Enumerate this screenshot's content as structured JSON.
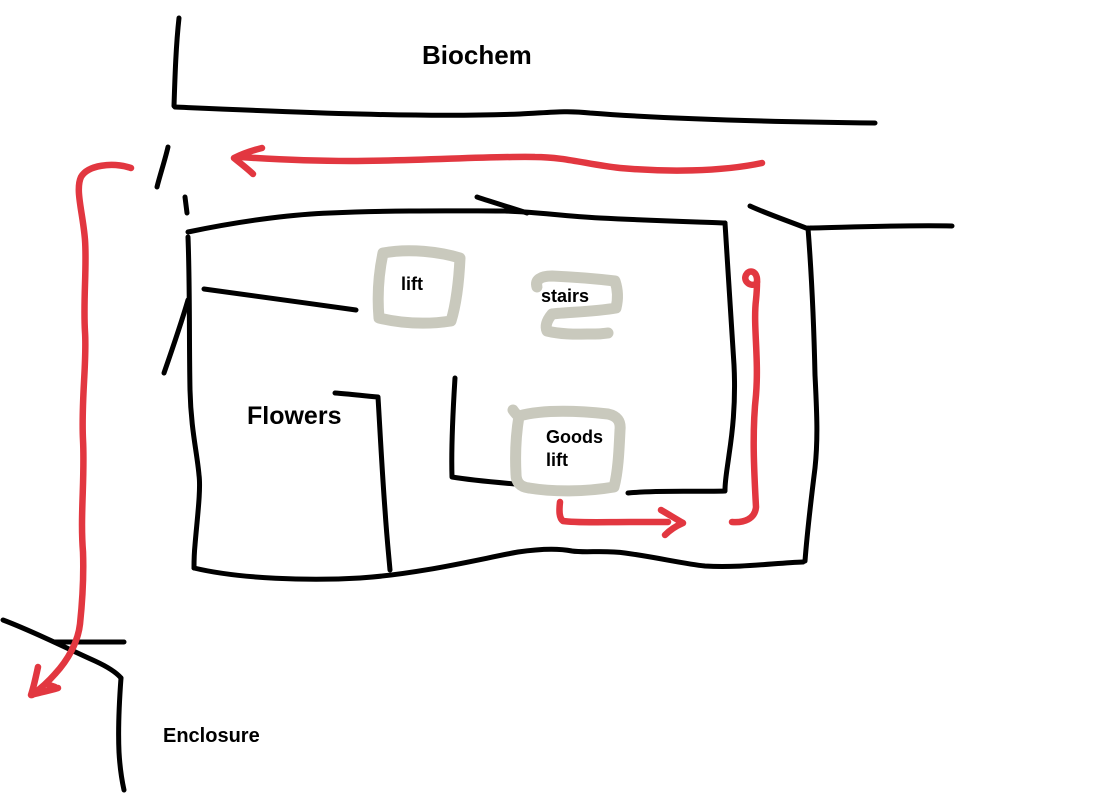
{
  "colors": {
    "ink": "#000000",
    "route": "#e23740",
    "zone": "#c9c9bd",
    "background": "#ffffff"
  },
  "labels": {
    "biochem": "Biochem",
    "flowers": "Flowers",
    "lift": "lift",
    "stairs": "stairs",
    "goods_lift_line1": "Goods",
    "goods_lift_line2": "lift",
    "enclosure": "Enclosure"
  }
}
